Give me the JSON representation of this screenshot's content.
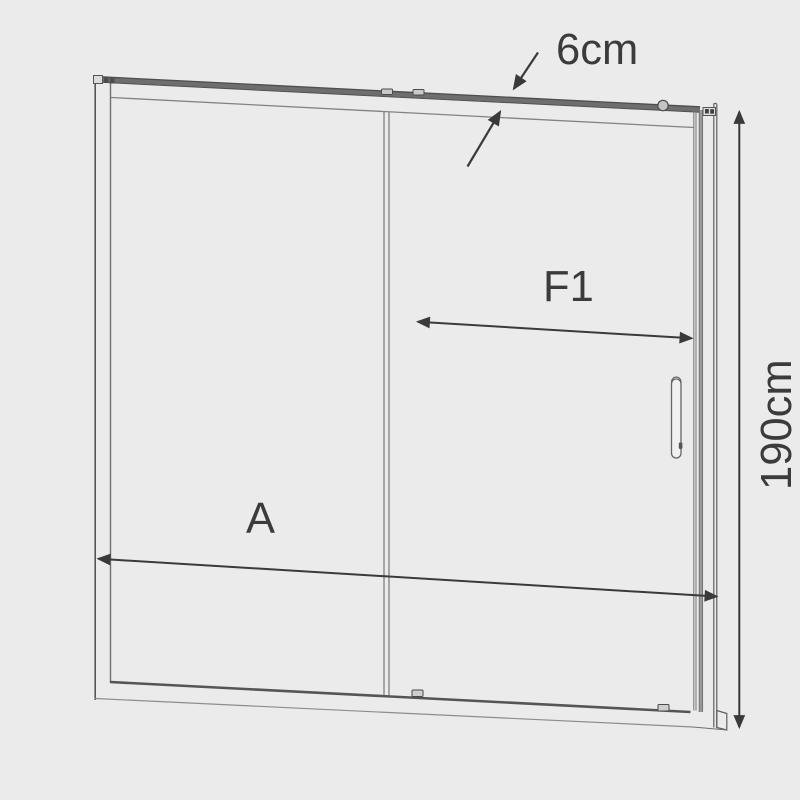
{
  "diagram": {
    "type": "product-dimension-diagram",
    "subject": "sliding-shower-door-two-panels",
    "labels": {
      "top_rail_dimension": "6cm",
      "sliding_panel_dimension": "F1",
      "overall_width_dimension": "A",
      "overall_height_dimension": "190cm"
    },
    "colors": {
      "background": "#ebebeb",
      "frame_line": "#5f5f5f",
      "light_line": "#8a8a8a",
      "dimension_line": "#3a3a3a",
      "label_text": "#3b3b3b"
    }
  }
}
